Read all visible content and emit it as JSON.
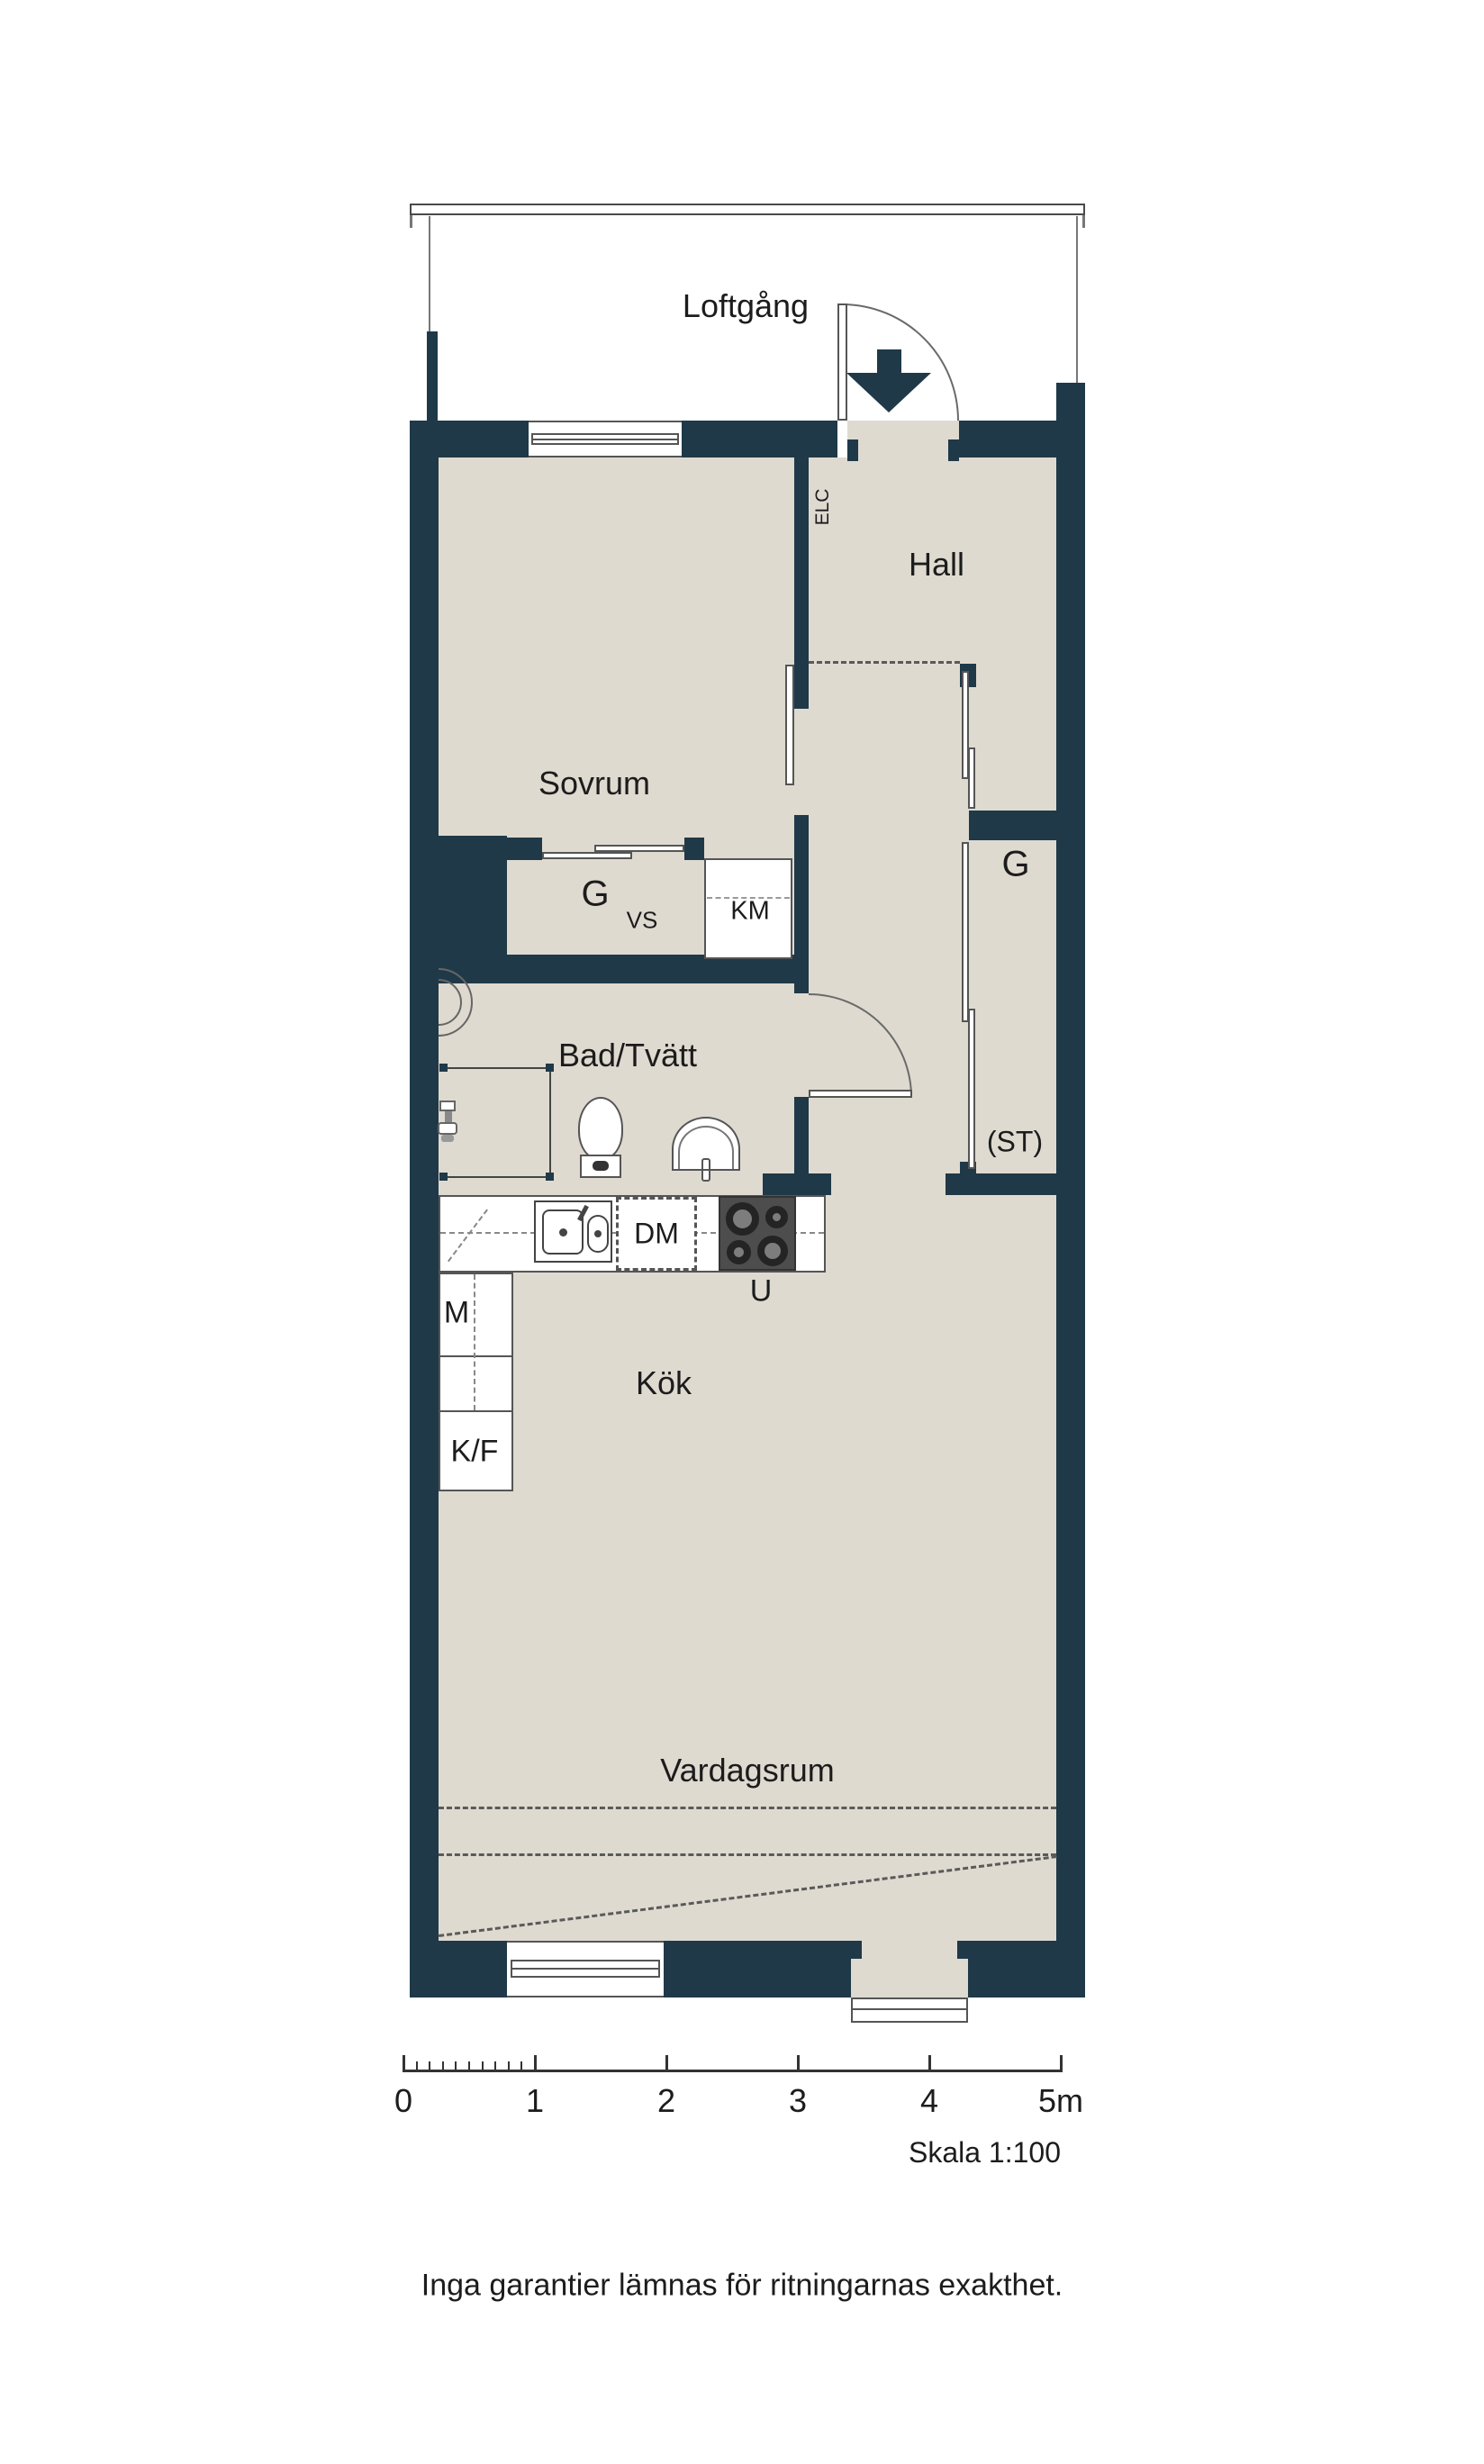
{
  "colors": {
    "wall": "#1f3948",
    "floor": "#dfdad0",
    "outline": "#555555",
    "text": "#1c1c1c",
    "stove": "#4d4d4d"
  },
  "rooms": {
    "loftgang": "Loftgång",
    "hall": "Hall",
    "sovrum": "Sovrum",
    "bad_tvatt": "Bad/Tvätt",
    "kok": "Kök",
    "vardagsrum": "Vardagsrum"
  },
  "labels": {
    "elc": "ELC",
    "g_closet": "G",
    "vs": "VS",
    "km": "KM",
    "g_wardrobe": "G",
    "st": "(ST)",
    "dm": "DM",
    "u": "U",
    "m": "M",
    "kf": "K/F"
  },
  "scale_bar": {
    "tick_labels": [
      "0",
      "1",
      "2",
      "3",
      "4",
      "5m"
    ],
    "meters": 5,
    "minor_per_meter": 10,
    "skala": "Skala 1:100"
  },
  "footer": {
    "disclaimer": "Inga garantier lämnas för ritningarnas exakthet."
  }
}
